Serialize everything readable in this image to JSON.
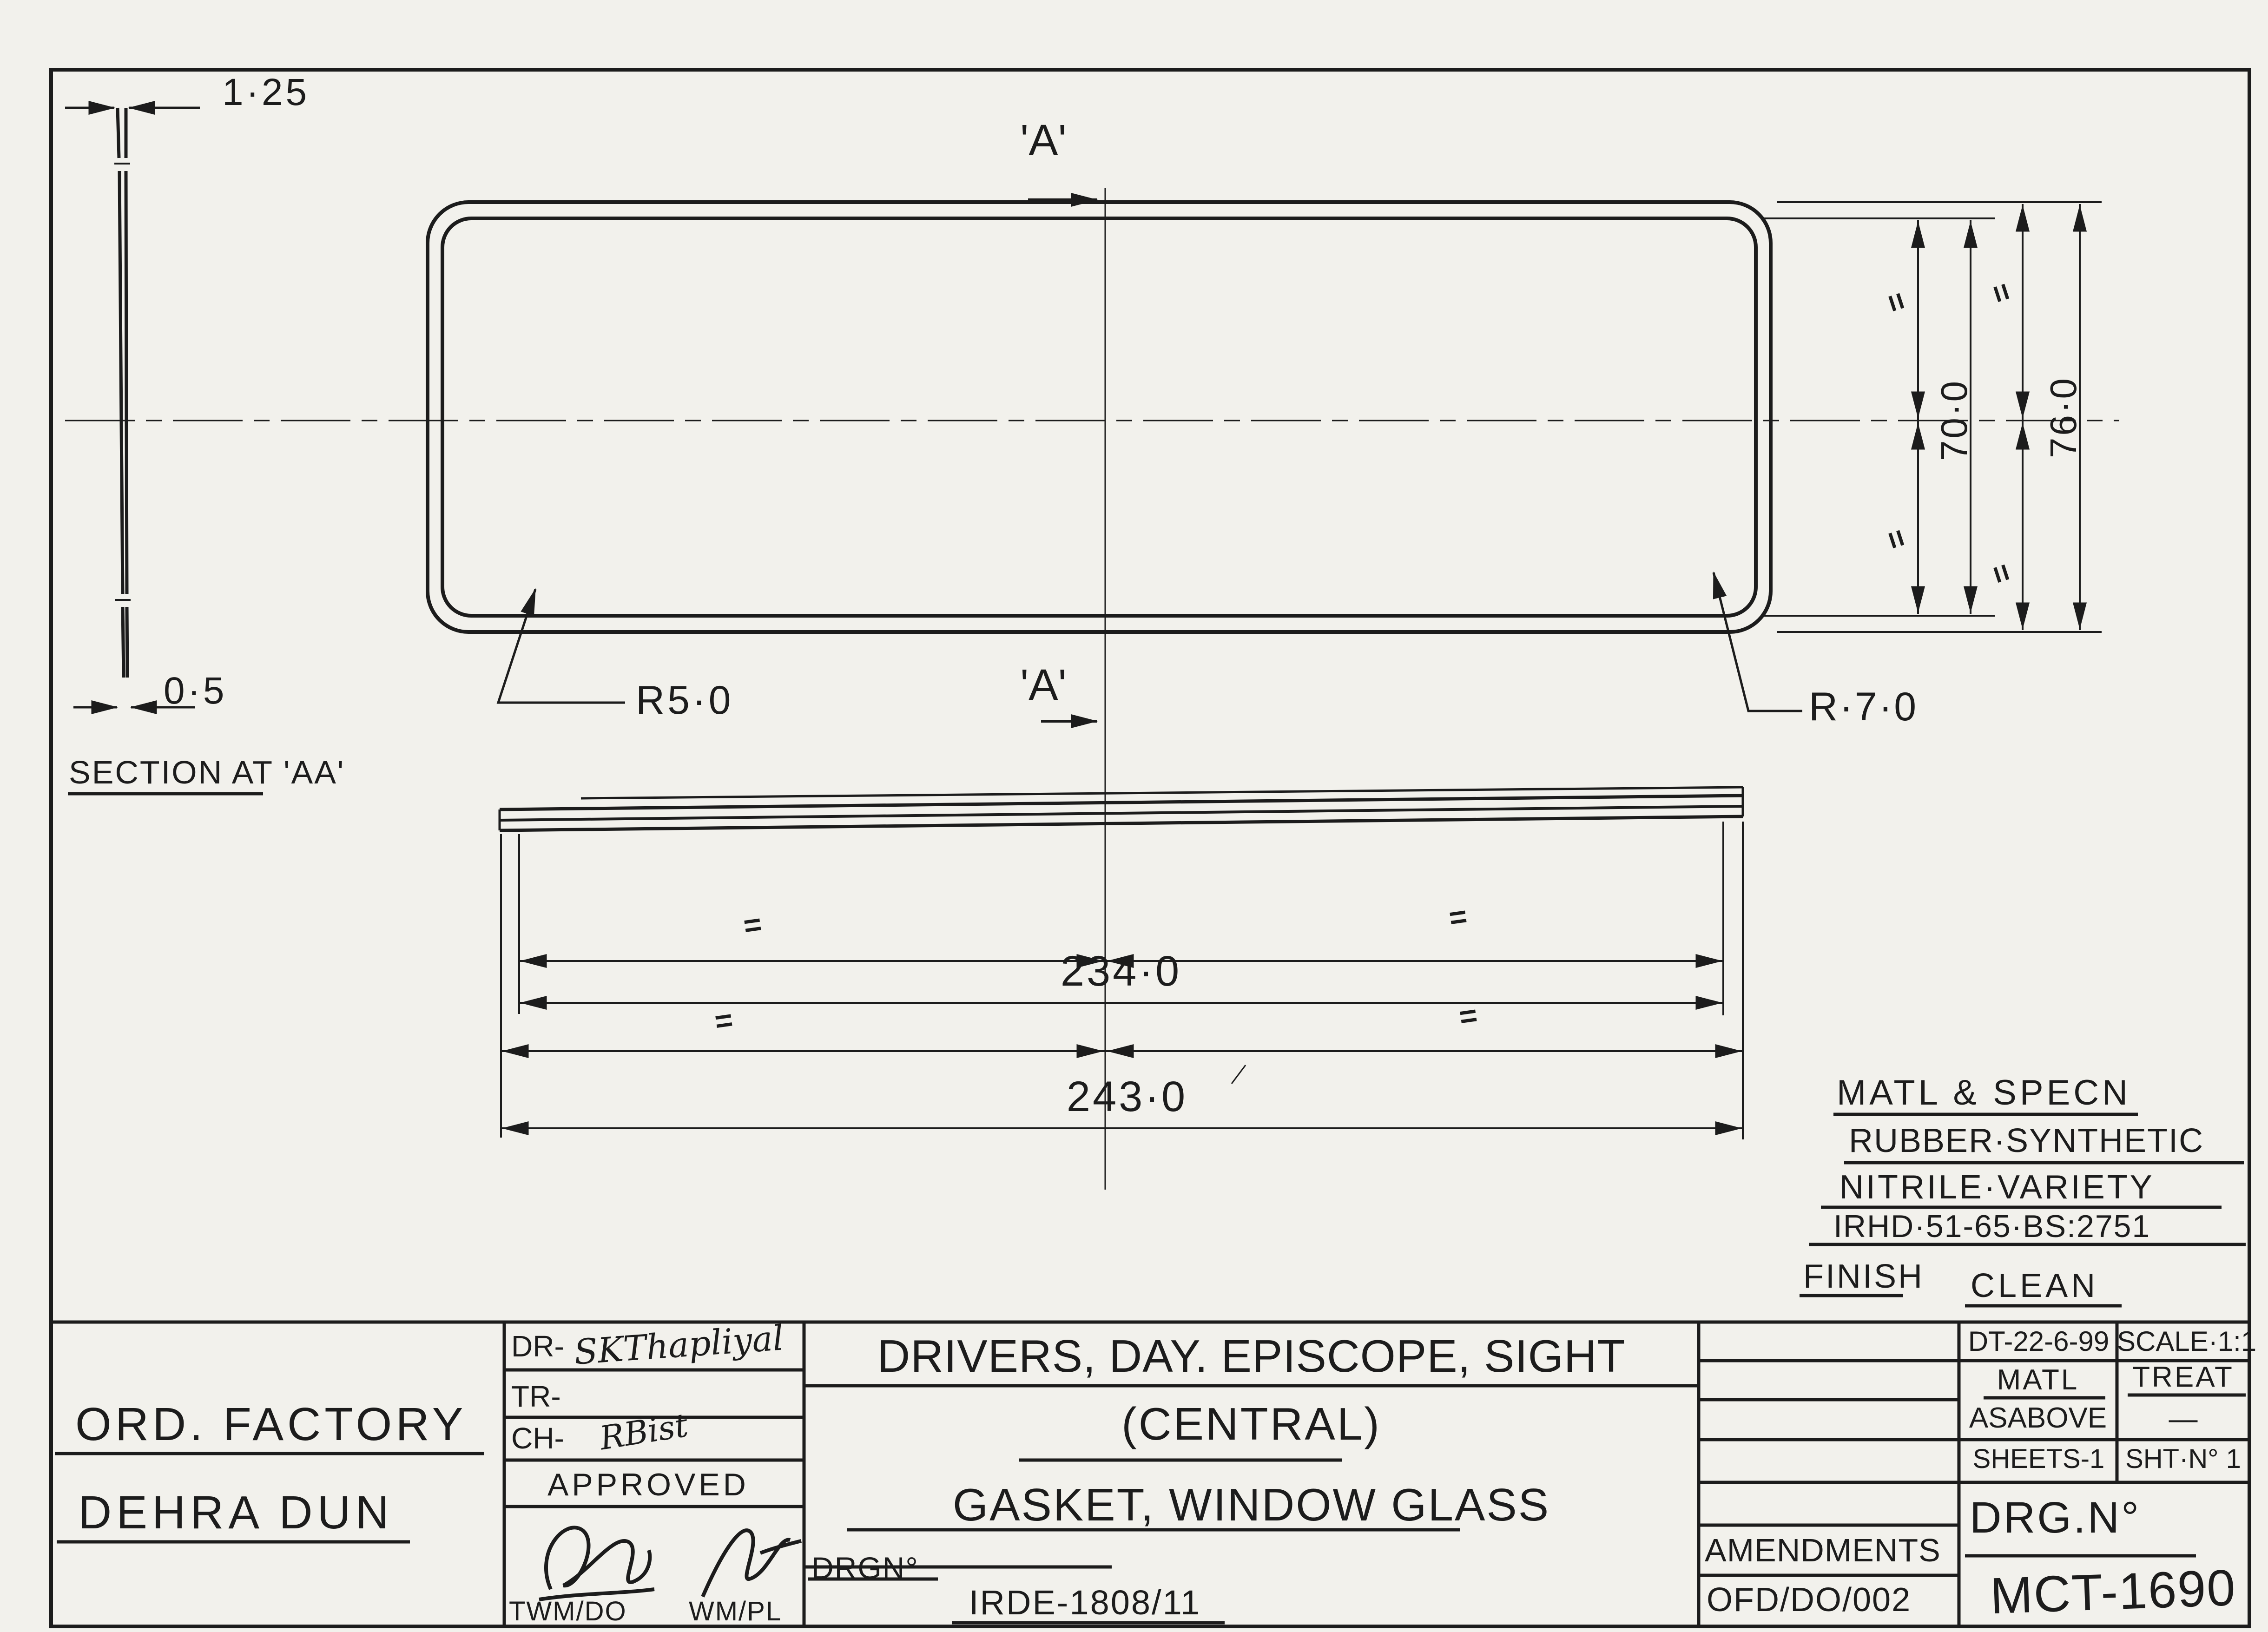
{
  "symbols": {
    "equal": "="
  },
  "section_view": {
    "dim_top": "1·25",
    "dim_bottom": "0·5",
    "caption": "SECTION AT 'AA'"
  },
  "plan_view": {
    "marker_top": "'A'",
    "marker_bottom": "'A'",
    "radius_left": "R5·0",
    "radius_right": "R·7·0",
    "dim_inner_height": "70·0",
    "dim_outer_height": "76·0"
  },
  "side_view": {
    "dim_inner_width": "234·0",
    "dim_outer_width": "243·0"
  },
  "notes": {
    "heading": "MATL & SPECN",
    "line1": "RUBBER·SYNTHETIC",
    "line2": "NITRILE·VARIETY",
    "line3": "IRHD·51-65·BS:2751",
    "finish_label": "FINISH",
    "finish_value": "CLEAN"
  },
  "title_block": {
    "factory_line1": "ORD. FACTORY",
    "factory_line2": "DEHRA DUN",
    "dr_label": "DR-",
    "dr_signature": "SKThapliyal",
    "tr_label": "TR-",
    "ch_label": "CH-",
    "ch_signature": "RBist",
    "approved_label": "APPROVED",
    "approver_left": "TWM/DO",
    "approver_right": "WM/PL",
    "title_line1": "DRIVERS, DAY. EPISCOPE, SIGHT",
    "title_line2": "(CENTRAL)",
    "title_line3": "GASKET, WINDOW GLASS",
    "drg_label": "DRGN°",
    "drg_value": "IRDE-1808/11",
    "date": "DT-22-6-99",
    "scale": "SCALE·1:1",
    "matl_label": "MATL",
    "matl_value": "ASABOVE",
    "treat_label": "TREAT",
    "treat_value": "—",
    "sheets": "SHEETS-1",
    "sheet_no": "SHT·N° 1",
    "drg_no_label": "DRG.N°",
    "drg_no_value": "MCT-1690",
    "amendments_label": "AMENDMENTS",
    "amendments_value": "OFD/DO/002"
  }
}
